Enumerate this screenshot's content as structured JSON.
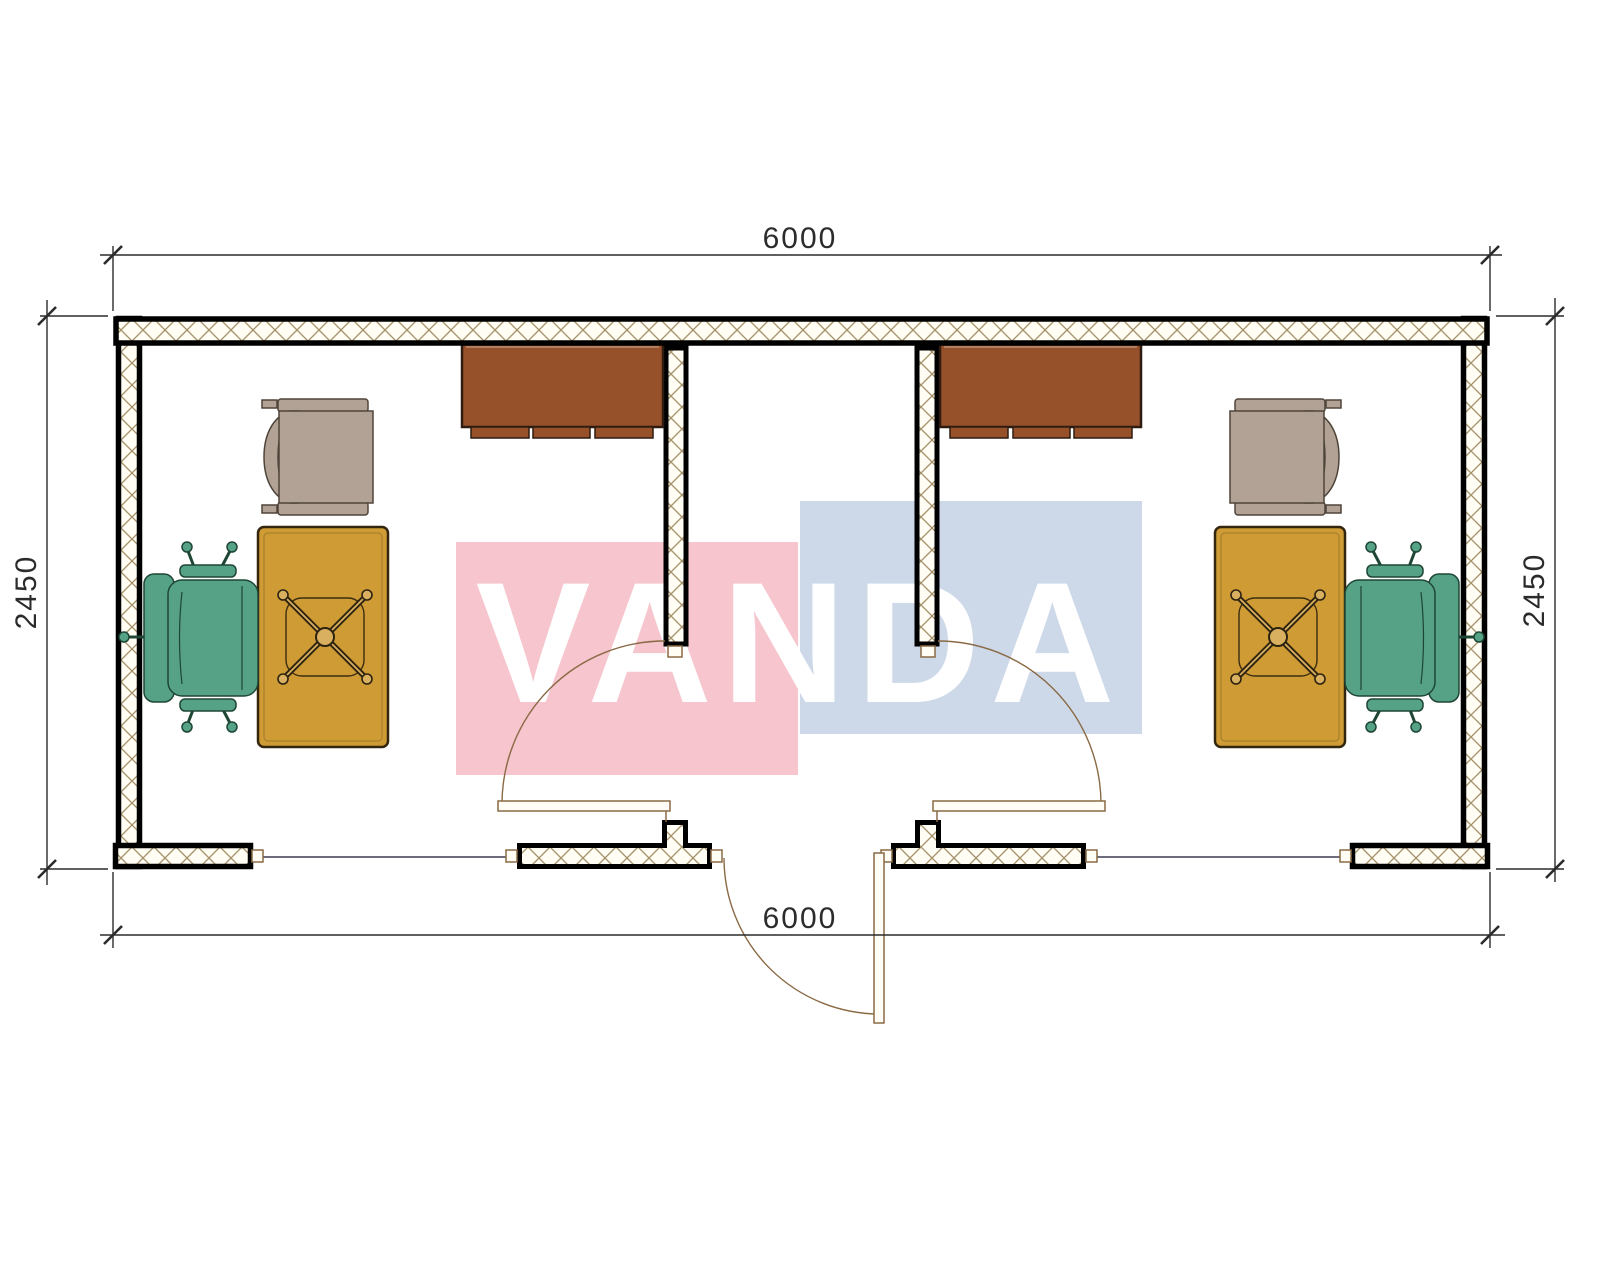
{
  "watermark": {
    "text": "VANDA",
    "pink_color": "#f6c5cd",
    "blue_color": "#cdd9e9",
    "text_color": "#ffffff"
  },
  "dimensions": {
    "width_top": "6000",
    "width_bottom": "6000",
    "height_left": "2450",
    "height_right": "2450"
  },
  "plan": {
    "colors": {
      "wall_fill": "#fffdf4",
      "wall_hatch_line": "#a5916a",
      "wall_edge": "#000000",
      "cabinet": "#96512b",
      "desk": "#cf9b35",
      "desk_hub": "#d8b060",
      "office_chair": "#55a287",
      "armchair": "#b2a295",
      "door_swing": "#8a6a45",
      "door_leaf_fill": "#fffdf6",
      "window_line": "#3b3b52",
      "dimension_line": "#2b2b2b"
    },
    "rooms": [
      "office-left",
      "office-right"
    ],
    "furniture": [
      "wall-cabinet",
      "desk",
      "office-chair",
      "armchair"
    ],
    "doors": [
      "interior-door-left",
      "interior-door-right",
      "entrance-door"
    ],
    "windows": [
      "window-left",
      "window-right"
    ]
  }
}
